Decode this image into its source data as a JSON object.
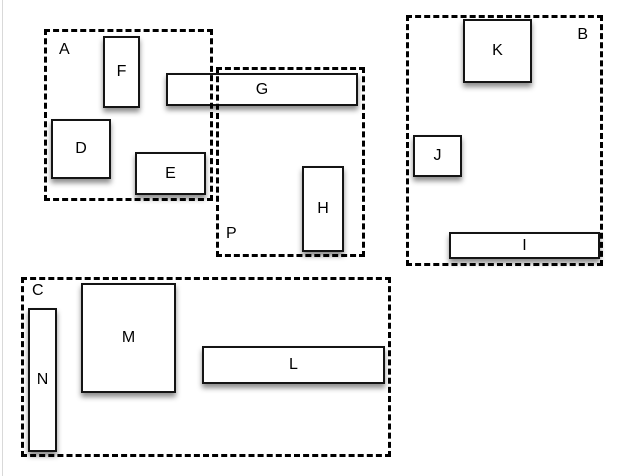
{
  "canvas": {
    "background": "#ffffff",
    "edge_line_color": "#d9d9d9"
  },
  "colors": {
    "shape_fill": "#ffffff",
    "shape_border": "#141414",
    "dashed_border": "#000000",
    "shadow": "rgba(0,0,0,0.45)"
  },
  "groups": [
    {
      "id": "A",
      "label": "A",
      "label_corner": "top-left"
    },
    {
      "id": "P",
      "label": "P",
      "label_corner": "bottom-left"
    },
    {
      "id": "B",
      "label": "B",
      "label_corner": "top-right"
    },
    {
      "id": "C",
      "label": "C",
      "label_corner": "top-left"
    }
  ],
  "boxes": [
    {
      "id": "D",
      "label": "D"
    },
    {
      "id": "E",
      "label": "E"
    },
    {
      "id": "F",
      "label": "F"
    },
    {
      "id": "G",
      "label": "G"
    },
    {
      "id": "H",
      "label": "H"
    },
    {
      "id": "I",
      "label": "I"
    },
    {
      "id": "J",
      "label": "J"
    },
    {
      "id": "K",
      "label": "K"
    },
    {
      "id": "L",
      "label": "L"
    },
    {
      "id": "M",
      "label": "M"
    },
    {
      "id": "N",
      "label": "N"
    }
  ]
}
